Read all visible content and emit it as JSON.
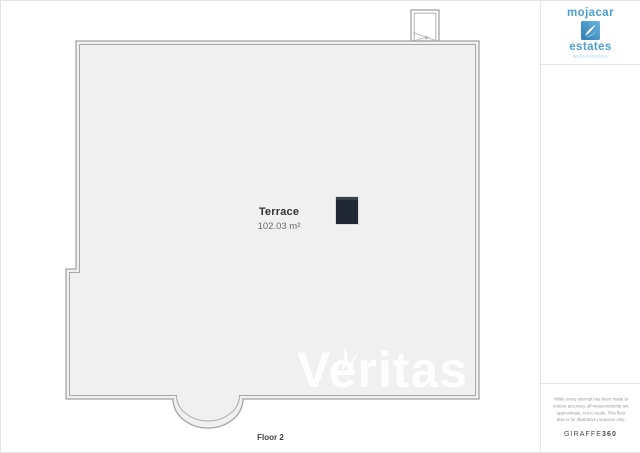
{
  "page": {
    "background_color": "#ffffff",
    "border_color": "#e4e4e4"
  },
  "floor_plan": {
    "room_label": "Terrace",
    "room_area": "102.03 m²",
    "floor_label": "Floor 2",
    "watermark": "Veritas",
    "interior_color": "#f0f0f0",
    "wall_line_color": "#a3a3a3",
    "chimney_color": "#1e2733"
  },
  "sidebar": {
    "logo": {
      "word_top": "mojacar",
      "word_bottom": "estates",
      "tagline": "SALES & RENTALS",
      "brand_color": "#4d9fce",
      "icon": "wave-sail-icon"
    },
    "disclaimer": {
      "line1": "While every attempt has been made to",
      "line2": "ensure accuracy, all measurements are",
      "line3": "approximate, not to scale. This floor",
      "line4": "plan is for illustrative purposes only.",
      "brand_prefix": "GIRAFFE",
      "brand_suffix": "360"
    }
  }
}
